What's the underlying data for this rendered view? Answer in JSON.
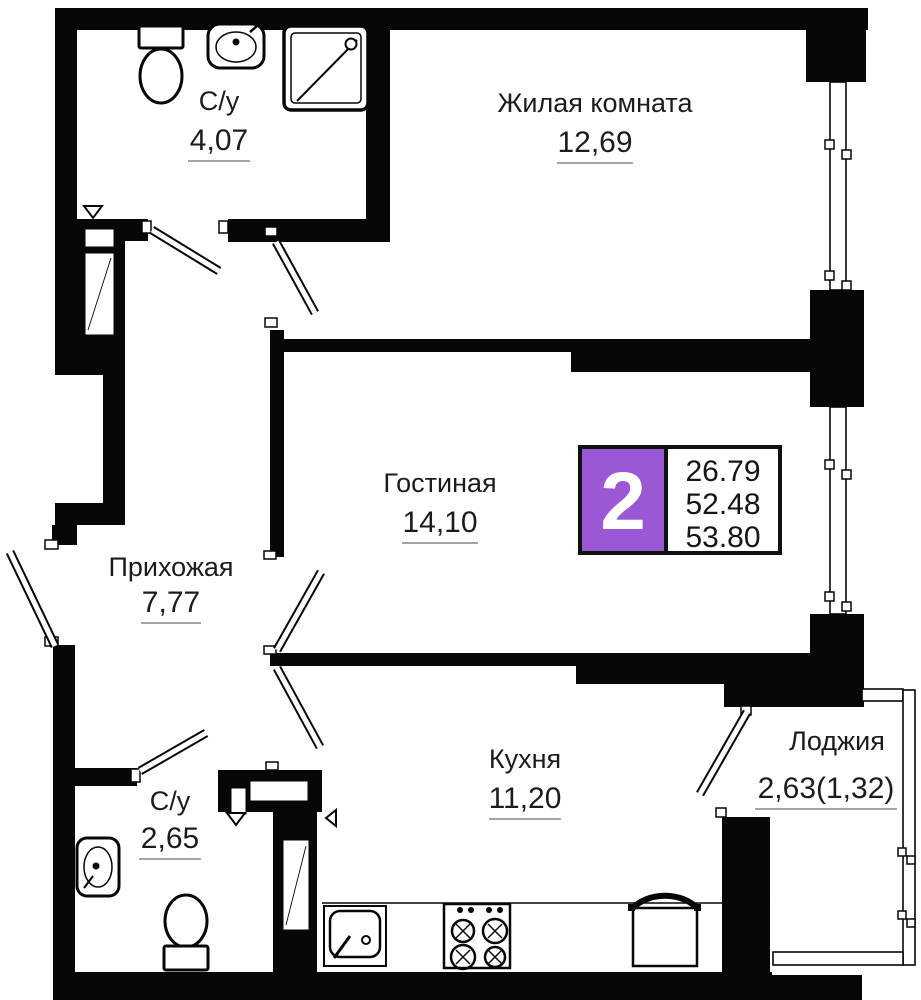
{
  "plan": {
    "title": "2-room apartment floor plan",
    "rooms": [
      {
        "id": "bathroom-top",
        "name": "С/у",
        "area": "4,07"
      },
      {
        "id": "living-room",
        "name": "Жилая комната",
        "area": "12,69"
      },
      {
        "id": "lounge",
        "name": "Гостиная",
        "area": "14,10"
      },
      {
        "id": "hallway",
        "name": "Прихожая",
        "area": "7,77"
      },
      {
        "id": "kitchen",
        "name": "Кухня",
        "area": "11,20"
      },
      {
        "id": "bathroom-bottom",
        "name": "С/у",
        "area": "2,65"
      },
      {
        "id": "loggia",
        "name": "Лоджия",
        "area": "2,63(1,32)"
      }
    ],
    "badge": {
      "rooms_count": "2",
      "areas": [
        "26.79",
        "52.48",
        "53.80"
      ],
      "accent_color": "#9a58d4"
    },
    "colors": {
      "walls": "#070707",
      "background": "#ffffff",
      "text": "#1c1c1c"
    }
  }
}
